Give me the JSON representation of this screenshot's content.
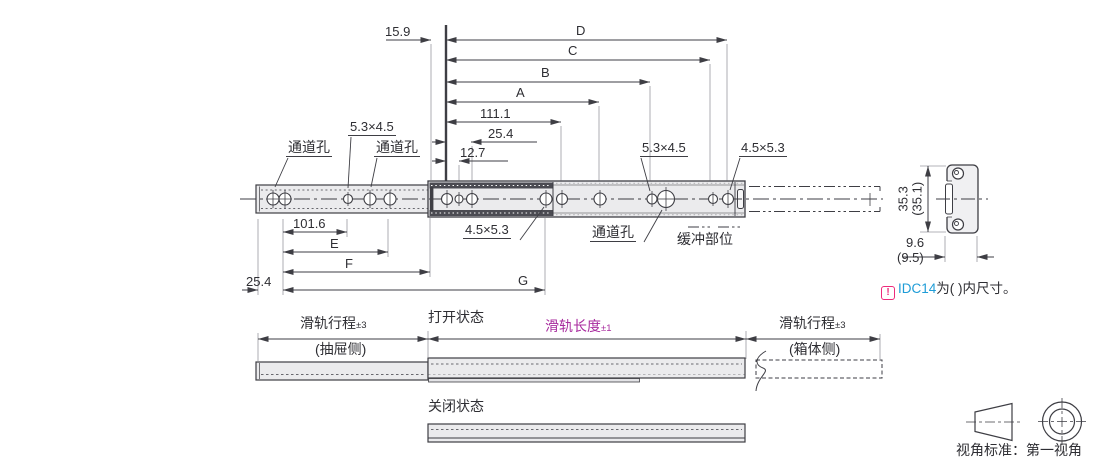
{
  "note": {
    "icon": "!",
    "code": "IDC14",
    "suffix": "为( )内尺寸。"
  },
  "dims": {
    "offset": "15.9",
    "D": "D",
    "C": "C",
    "B": "B",
    "A": "A",
    "l111": "111.1",
    "l25": "25.4",
    "l12": "12.7",
    "l101": "101.6",
    "E": "E",
    "F": "F",
    "G": "G",
    "left25": "25.4"
  },
  "labels": {
    "channel_hole": "通道孔",
    "slot_a": "5.3×4.5",
    "slot_b": "4.5×5.3",
    "buffer_zone": "缓冲部位"
  },
  "section": {
    "height": "35.3",
    "height_paren": "(35.1)",
    "width": "9.6",
    "width_paren": "(9.5)"
  },
  "states": {
    "open": "打开状态",
    "closed": "关闭状态",
    "travel": "滑轨行程",
    "travel_tol": "±3",
    "drawer_side": "(抽屉侧)",
    "cabinet_side": "(箱体侧)",
    "length": "滑轨长度",
    "length_tol": "±1"
  },
  "footer": {
    "projection_label": "视角标准：第一视角"
  },
  "colors": {
    "line": "#3e3e44",
    "extension": "#9a9aa0",
    "rail_fill": "#ebebed",
    "band": "#4b4b52",
    "magenta": "#a82b9e",
    "blue": "#1e9cd7",
    "pink": "#ee2a7b"
  }
}
